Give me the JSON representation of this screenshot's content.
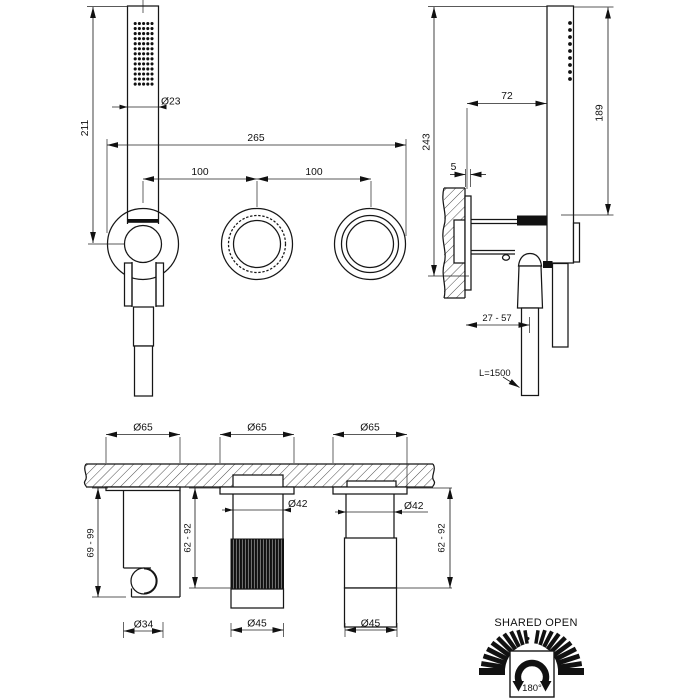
{
  "drawing": {
    "front_view": {
      "hand_shower_length": "211",
      "hand_shower_diameter": "Ø23",
      "total_width": "265",
      "center_distance_left": "100",
      "center_distance_right": "100"
    },
    "side_view": {
      "total_height": "243",
      "wall_to_shower": "72",
      "shower_height": "189",
      "plate_gap": "5",
      "wall_to_handle": "27 - 57",
      "hose_length": "L=1500"
    },
    "plan_view": {
      "escutcheon_diameter_1": "Ø65",
      "escutcheon_diameter_2": "Ø65",
      "escutcheon_diameter_3": "Ø65",
      "stem_diameter_2": "Ø42",
      "stem_diameter_3": "Ø42",
      "holder_projection": "69 - 99",
      "handle_projection_2": "62 - 92",
      "handle_projection_3": "62 - 92",
      "holder_diameter": "Ø34",
      "handle_diameter_2": "Ø45",
      "handle_diameter_3": "Ø45"
    },
    "rotation_legend": {
      "title": "SHARED OPEN",
      "left_label": "OPEN",
      "right_label": "OPEN",
      "angle_label": "180°"
    },
    "colors": {
      "line": "#161616",
      "background": "#ffffff"
    }
  }
}
